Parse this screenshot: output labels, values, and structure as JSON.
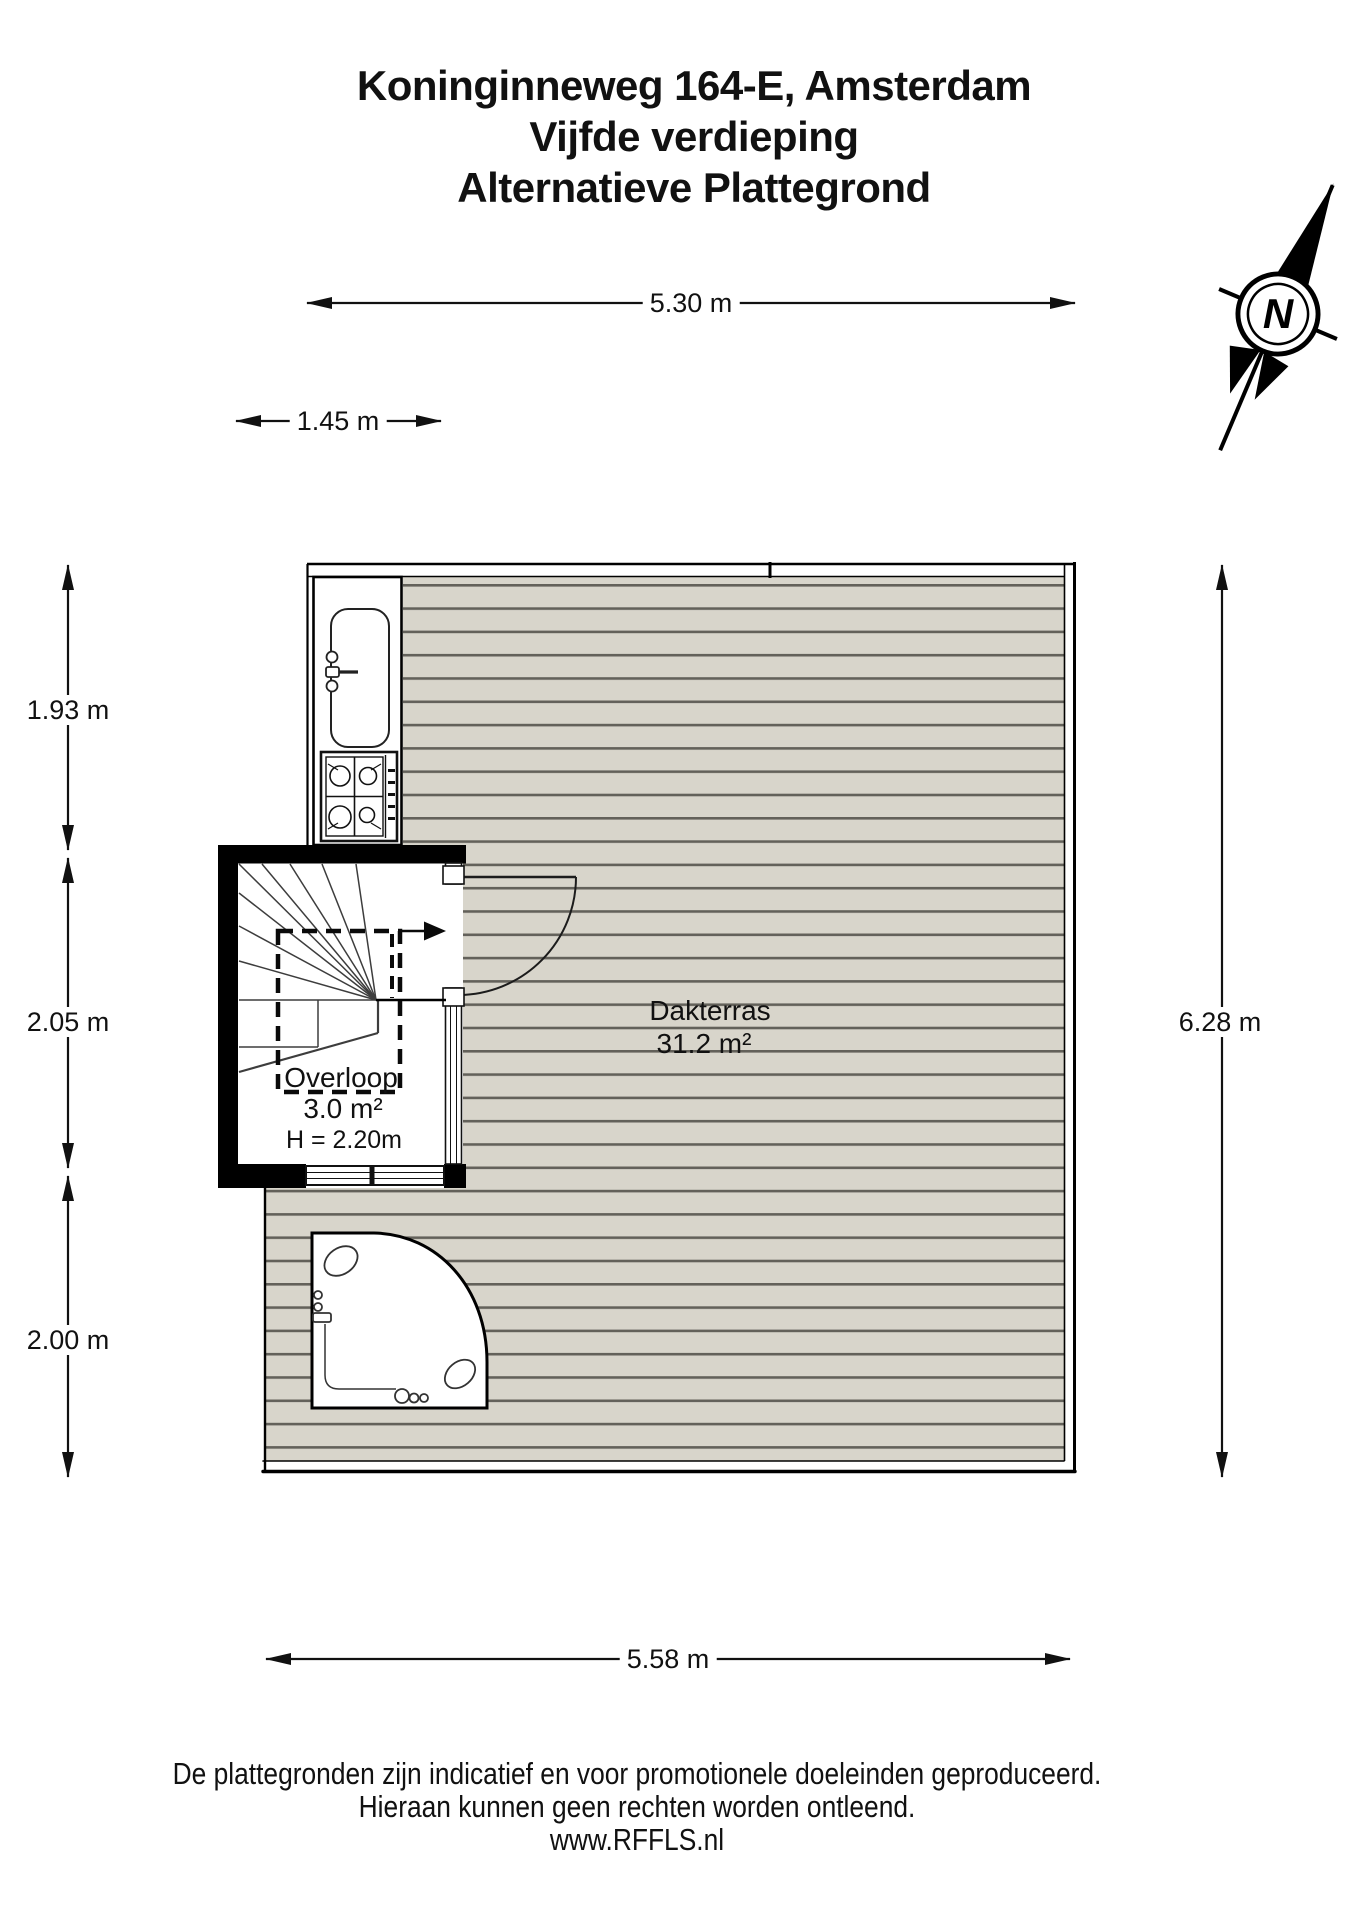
{
  "title": {
    "address": "Koninginneweg 164-E, Amsterdam",
    "floor": "Vijfde verdieping",
    "variant": "Alternatieve Plattegrond"
  },
  "compass": {
    "north_label": "N"
  },
  "dimensions": {
    "top_width": "5.30 m",
    "landing_width": "1.45 m",
    "left_top": "1.93 m",
    "left_middle": "2.05 m",
    "left_bottom": "2.00 m",
    "right_height": "6.28 m",
    "bottom_width": "5.58 m"
  },
  "rooms": {
    "dakterras": {
      "name": "Dakterras",
      "area": "31.2 m²"
    },
    "overloop": {
      "name": "Overloop",
      "area": "3.0 m²",
      "ceiling_height": "H = 2.20m"
    }
  },
  "footer": {
    "disclaimer_line1": "De plattegronden zijn indicatief en voor promotionele doeleinden geproduceerd.",
    "disclaimer_line2": "Hieraan kunnen geen rechten worden ontleend.",
    "website": "www.RFFLS.nl"
  },
  "colors": {
    "deck_fill": "#d8d5cb",
    "deck_line": "#63615a",
    "wall": "#000000"
  }
}
